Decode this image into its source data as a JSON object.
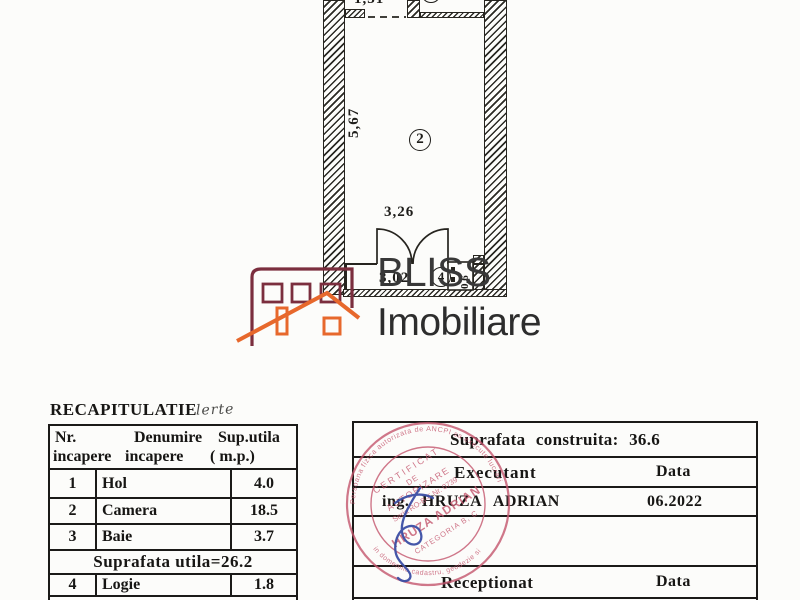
{
  "plan": {
    "dim_hol_width": "1,31",
    "dim_room_height": "5,67",
    "dim_room_width": "3,26",
    "dim_logia_width": "3,02",
    "dim_logia_depth": "0,6",
    "label_bath": "3",
    "label_room": "2",
    "label_logia": "4"
  },
  "logo": {
    "title": "BLISS",
    "subtitle": "Imobiliare"
  },
  "recap": {
    "title": "RECAPITULATIE",
    "title_note": "lerte",
    "header": {
      "nr": "Nr.",
      "denumire": "Denumire",
      "sup": "Sup.utila",
      "incapere1": "incapere",
      "incapere2": "incapere",
      "mp": "( m.p.)"
    },
    "rows": [
      {
        "nr": "1",
        "name": "Hol",
        "area": "4.0"
      },
      {
        "nr": "2",
        "name": "Camera",
        "area": "18.5"
      },
      {
        "nr": "3",
        "name": "Baie",
        "area": "3.7"
      },
      {
        "nr": "4",
        "name": "Logie",
        "area": "1.8"
      }
    ],
    "summary": "Suprafata utila=26.2"
  },
  "info": {
    "built_area": "Suprafata construita: 36.6",
    "executant_label": "Executant",
    "executant_data_label": "Data",
    "executant_name": "ing. HRUZA ADRIAN",
    "executant_date": "06.2022",
    "receptionat_label": "Receptionat",
    "receptionat_data_label": "Data"
  },
  "stamp": {
    "ring_top": "Persoana fizica autorizata de ANCPI sa execute lucrari",
    "ring_bottom": "in domeniile cadastru, geodezie si cartografie",
    "cert_line1": "CERTIFICAT",
    "cert_line2": "DE",
    "cert_line3": "AUTORIZARE",
    "serial": "Seria RO-B-F Nr. 0739",
    "name": "HRUZA ADRIAN",
    "category": "CATEGORIA B, C"
  },
  "colors": {
    "ink": "#1e1d1a",
    "logo_maroon": "#7b2e3e",
    "logo_orange": "#e7682c",
    "stamp_red": "#c4566e",
    "signature_blue": "#3c4fa5"
  }
}
